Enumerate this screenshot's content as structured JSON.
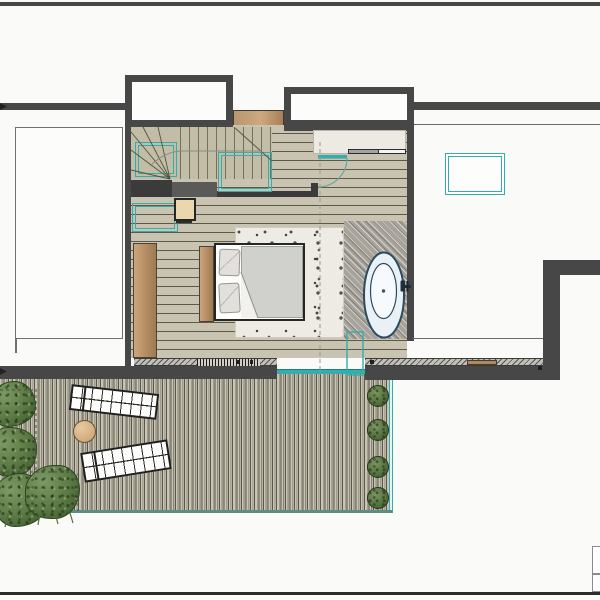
{
  "meta": {
    "domain": "Computer-Use",
    "description": "Architectural floor plan, upper level: bedroom with open bath, winder staircase, walk-in closet and roof deck terrace",
    "visible_text": []
  },
  "palette": {
    "background": "#fafaf9",
    "wall": "#474747",
    "teal_accent": "#35adad",
    "wood_floor": "#c9c4b1",
    "deck_plank": "#b5b1a1",
    "furniture_wood": "#c09c72",
    "bath_tile": "#a7a39b",
    "rug": "#edebe4",
    "plant_green": "#5a7843",
    "tub_outline": "#2a4b60"
  },
  "plan": {
    "rooms": [
      {
        "name": "bedroom",
        "floor": "wood planks"
      },
      {
        "name": "open-bathroom",
        "floor": "grey tile with freestanding tub"
      },
      {
        "name": "stair-hall",
        "feature": "winder staircase"
      },
      {
        "name": "walk-in-closet",
        "feature": "sliding doors"
      },
      {
        "name": "roof-deck",
        "floor": "narrow decking boards"
      },
      {
        "name": "lower-roof",
        "note": "white flat roof areas left and right"
      }
    ],
    "furniture": [
      {
        "label": "Double bed with wood headboard, two pillows and duvet"
      },
      {
        "label": "Freestanding oval bathtub with wall-mounted faucet"
      },
      {
        "label": "Bedside stool"
      },
      {
        "label": "Built-in wardrobe panel"
      },
      {
        "label": "Lounge chair (upper)"
      },
      {
        "label": "Lounge chair (lower)"
      },
      {
        "label": "Round side table"
      }
    ],
    "openings": [
      {
        "label": "Hinged bedroom door with swing arc",
        "color": "teal"
      },
      {
        "label": "Sliding glass door to deck",
        "color": "teal"
      },
      {
        "label": "Closet sliding door leaves"
      }
    ],
    "skylights": [
      {
        "label": "Skylight over winder stair"
      },
      {
        "label": "Skylight over stair flight"
      },
      {
        "label": "Floor void outline at stair landing"
      },
      {
        "label": "Roof skylight on right flat roof"
      }
    ],
    "landscape": {
      "planter_pots": 4,
      "bushes": 4,
      "dashed_planting_beds": 2,
      "deck_edge_color": "teal"
    },
    "stairs": {
      "label": "Winder staircase",
      "treads_visible": 11
    },
    "legend_box": {
      "rows": 2,
      "position": "bottom-right edge"
    }
  }
}
